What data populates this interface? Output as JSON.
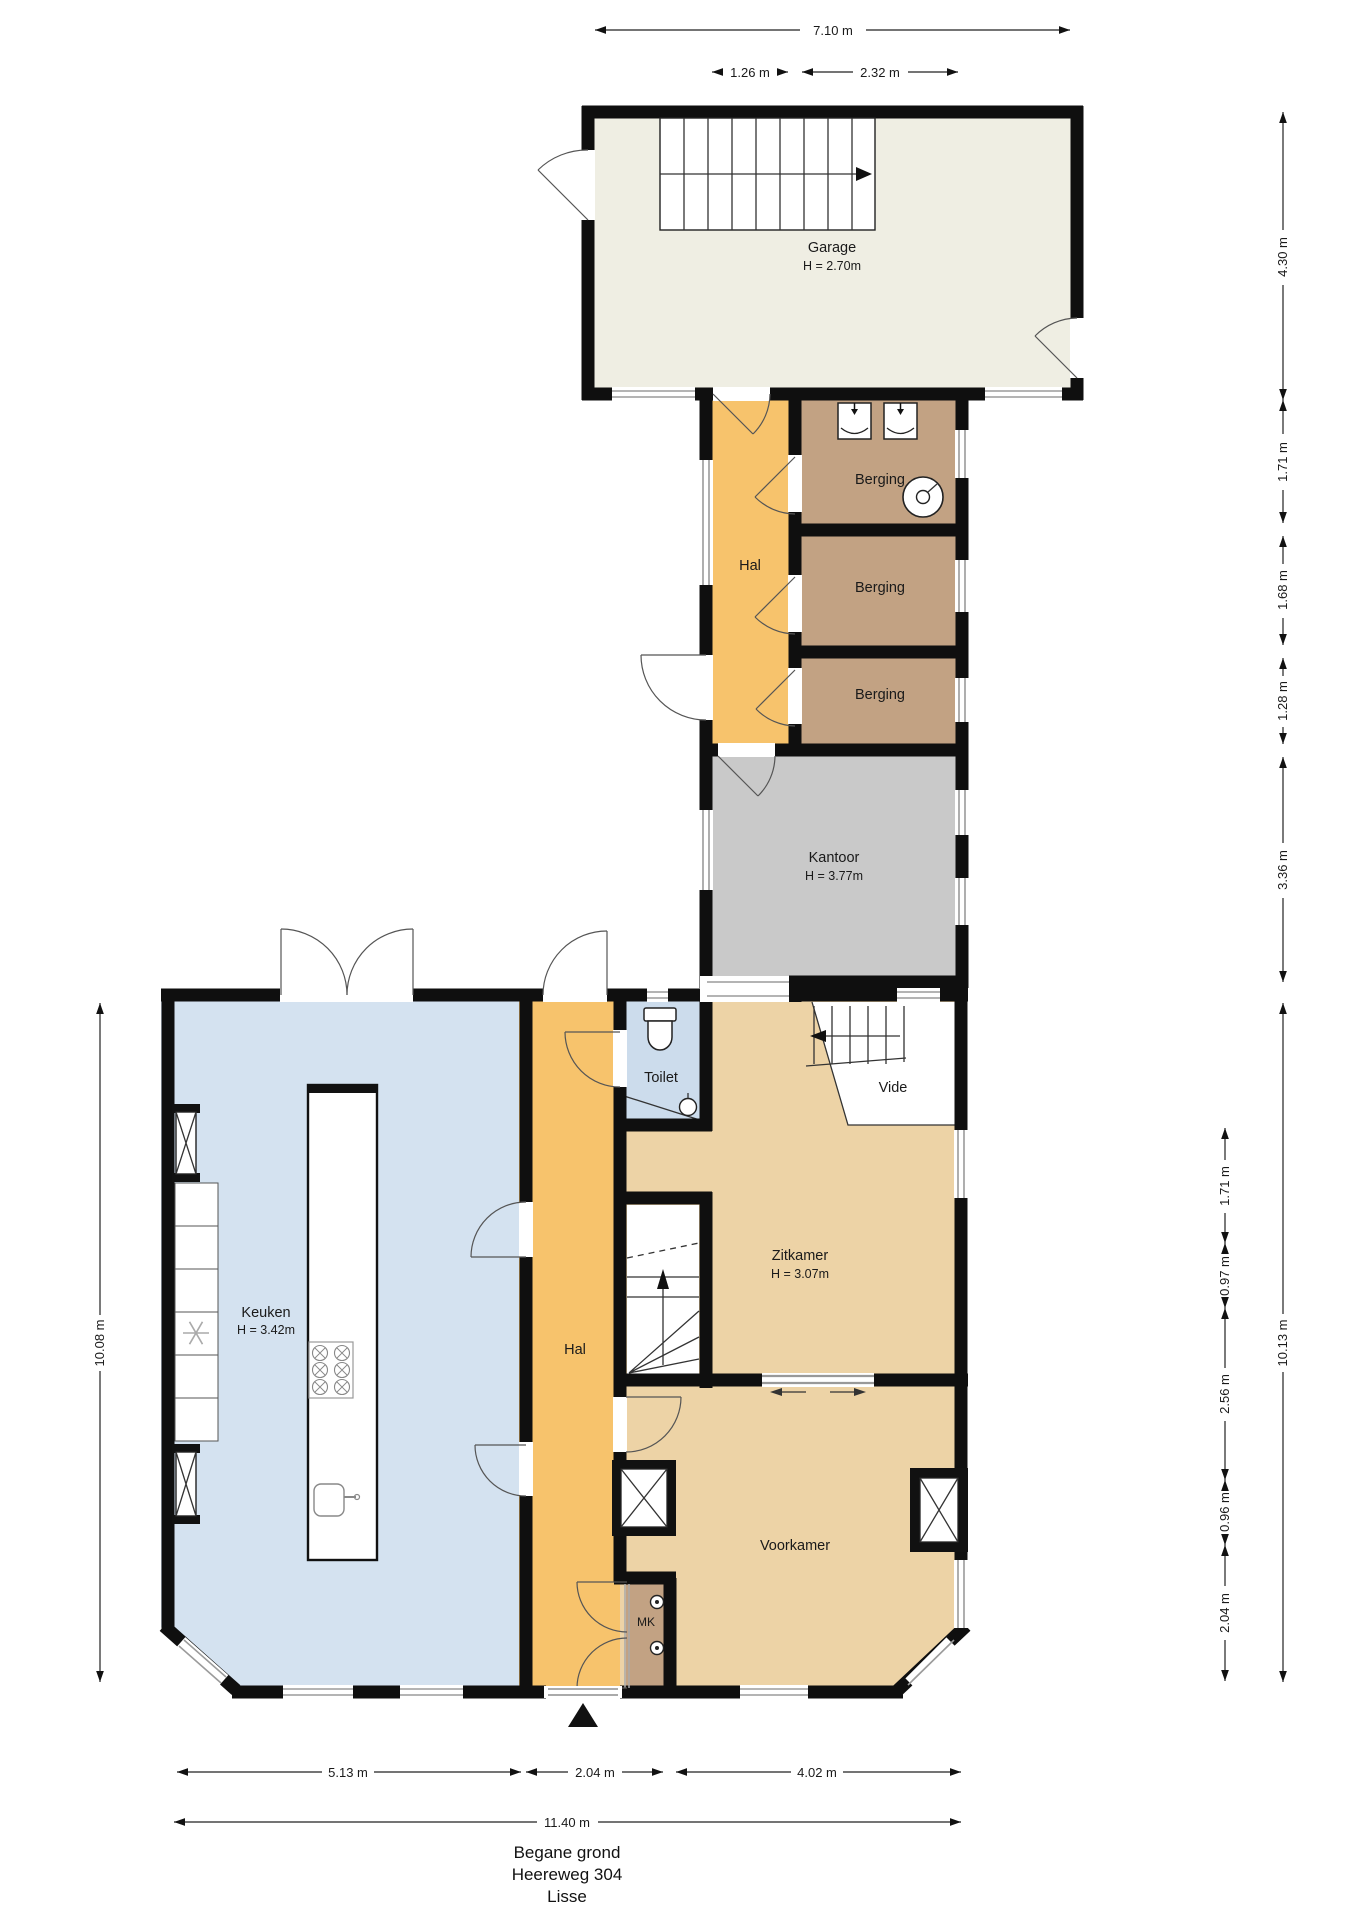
{
  "plan": {
    "footer": {
      "floor": "Begane grond",
      "address": "Heereweg 304",
      "city": "Lisse"
    },
    "rooms": {
      "garage": {
        "label": "Garage",
        "height": "H = 2.70m",
        "color": "#efeee3"
      },
      "hal_boven": {
        "label": "Hal",
        "color": "#f7c36c"
      },
      "berging_1": {
        "label": "Berging",
        "color": "#c2a283"
      },
      "berging_2": {
        "label": "Berging",
        "color": "#c2a283"
      },
      "berging_3": {
        "label": "Berging",
        "color": "#c2a283"
      },
      "kantoor": {
        "label": "Kantoor",
        "height": "H = 3.77m",
        "color": "#c9c9c9"
      },
      "keuken": {
        "label": "Keuken",
        "height": "H = 3.42m",
        "color": "#d4e2f0"
      },
      "hal": {
        "label": "Hal",
        "color": "#f7c36c"
      },
      "toilet": {
        "label": "Toilet",
        "color": "#ccdcec"
      },
      "vide": {
        "label": "Vide",
        "color": "#ffffff"
      },
      "zitkamer": {
        "label": "Zitkamer",
        "height": "H = 3.07m",
        "color": "#edd3a6"
      },
      "voorkamer": {
        "label": "Voorkamer",
        "color": "#edd3a6"
      },
      "meterkast": {
        "label": "MK",
        "color": "#c2a283"
      }
    },
    "dimensions": {
      "top": {
        "total": "7.10 m",
        "hal": "1.26 m",
        "berging": "2.32 m"
      },
      "right_outer": {
        "garage": "4.30 m",
        "berging_1": "1.71 m",
        "berging_2": "1.68 m",
        "berging_3": "1.28 m",
        "kantoor": "3.36 m",
        "house": "10.13 m"
      },
      "right_inner": {
        "seg_1": "1.71 m",
        "seg_2": "0.97 m",
        "seg_3": "2.56 m",
        "seg_4": "0.96 m",
        "seg_5": "2.04 m"
      },
      "left": {
        "house": "10.08 m"
      },
      "bottom": {
        "keuken": "5.13 m",
        "hal": "2.04 m",
        "voorkamer": "4.02 m",
        "total": "11.40 m"
      }
    },
    "wall_color": "#0f0f0f"
  }
}
